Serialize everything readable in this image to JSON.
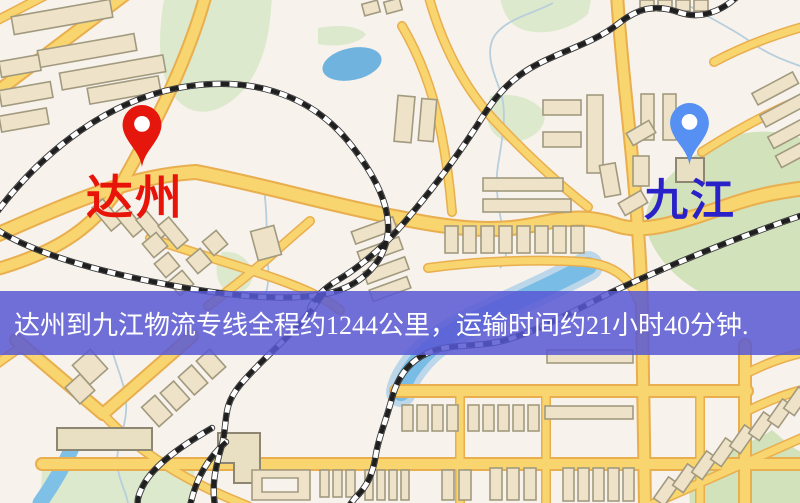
{
  "map": {
    "origin": {
      "name": "达州",
      "pin_color": "#e5170d",
      "label_color": "#e8140a"
    },
    "destination": {
      "name": "九江",
      "pin_color": "#5590f2",
      "label_color": "#2a22c9"
    }
  },
  "banner": {
    "text": "达州到九江物流专线全程约1244公里，运输时间约21小时40分钟.",
    "bg_color": "#5858d4",
    "text_color": "#ffffff"
  }
}
